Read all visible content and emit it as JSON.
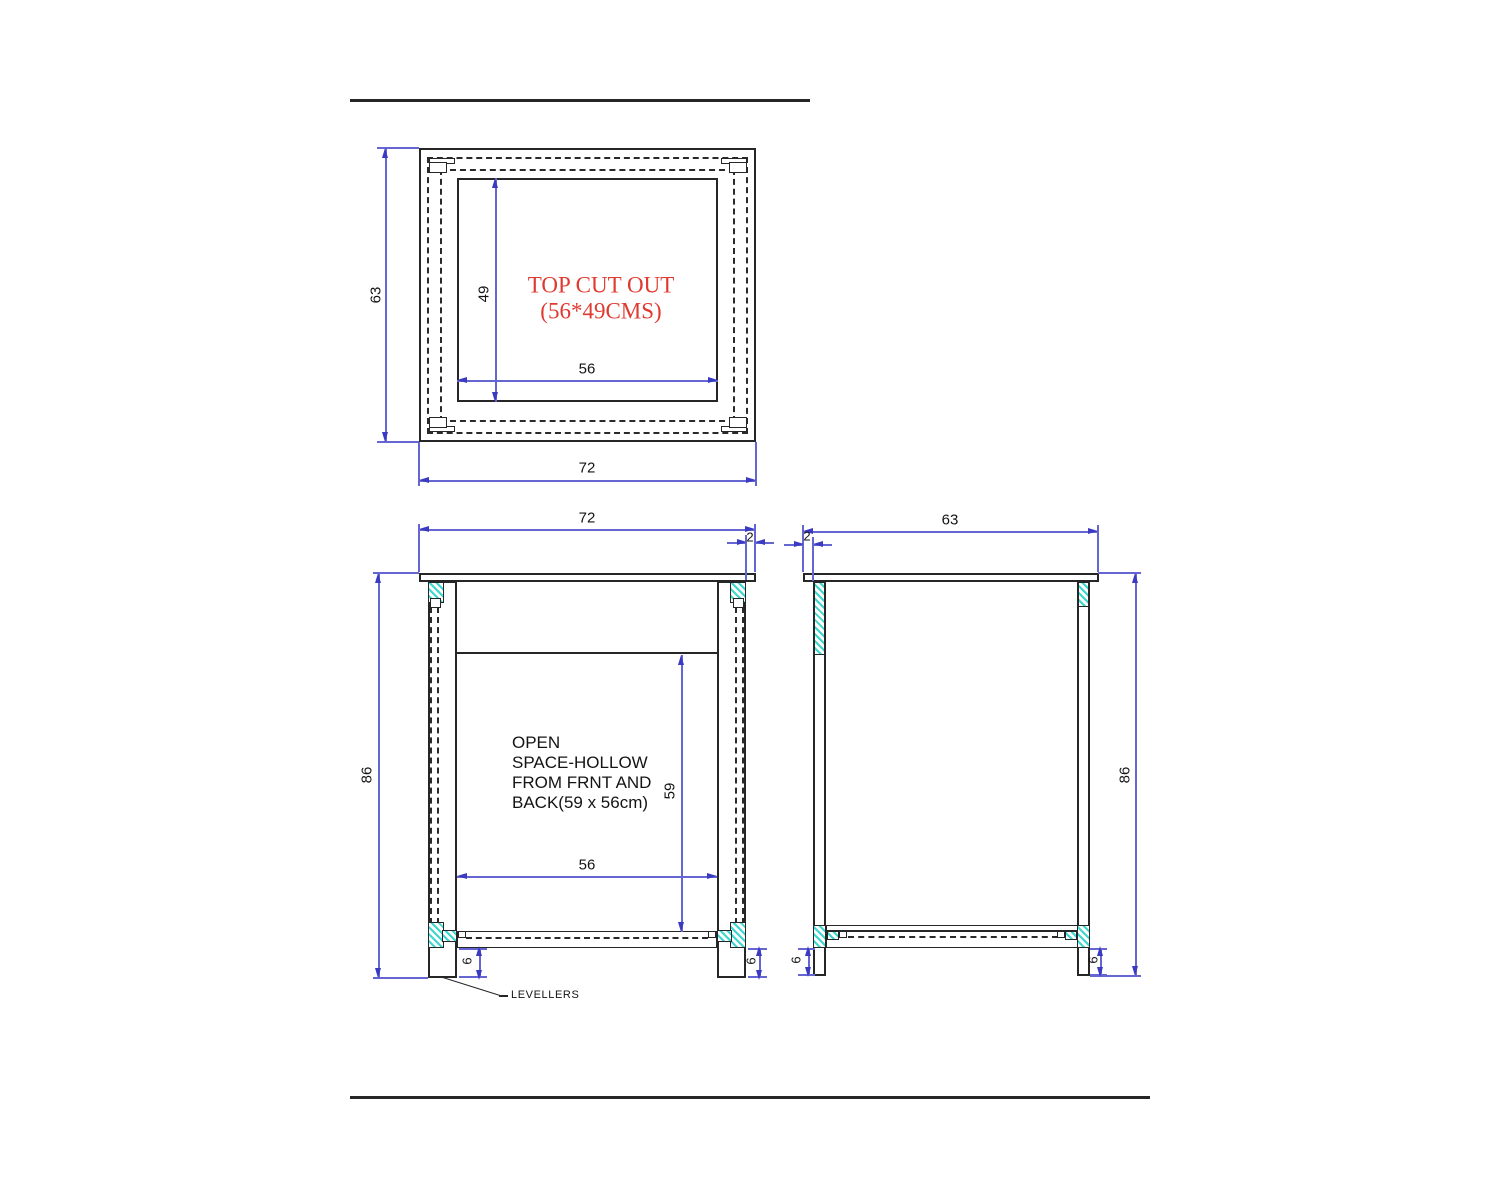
{
  "drawing": {
    "colors": {
      "line": "#262626",
      "dimension": "#6666d2",
      "arrow": "#3a3ac2",
      "hatch": "#3cd8cf",
      "annotation_red": "#e03a30"
    },
    "top_view": {
      "title_line1": "TOP CUT OUT",
      "title_line2": "(56*49CMS)",
      "dim_depth": "63",
      "dim_cutout_depth": "49",
      "dim_cutout_width": "56",
      "dim_width": "72"
    },
    "front_view": {
      "dim_width": "72",
      "dim_top_overhang": "2",
      "dim_height": "86",
      "dim_open_height": "59",
      "dim_open_width": "56",
      "dim_leveller_left": "6",
      "dim_leveller_right": "6",
      "note_line1": "OPEN",
      "note_line2": "SPACE-HOLLOW",
      "note_line3": "FROM FRNT AND",
      "note_line4": "BACK(59 x 56cm)",
      "levellers_label": "LEVELLERS"
    },
    "side_view": {
      "dim_top_overhang": "2",
      "dim_depth": "63",
      "dim_height": "86",
      "dim_leveller_left": "6",
      "dim_leveller_right": "6"
    }
  }
}
